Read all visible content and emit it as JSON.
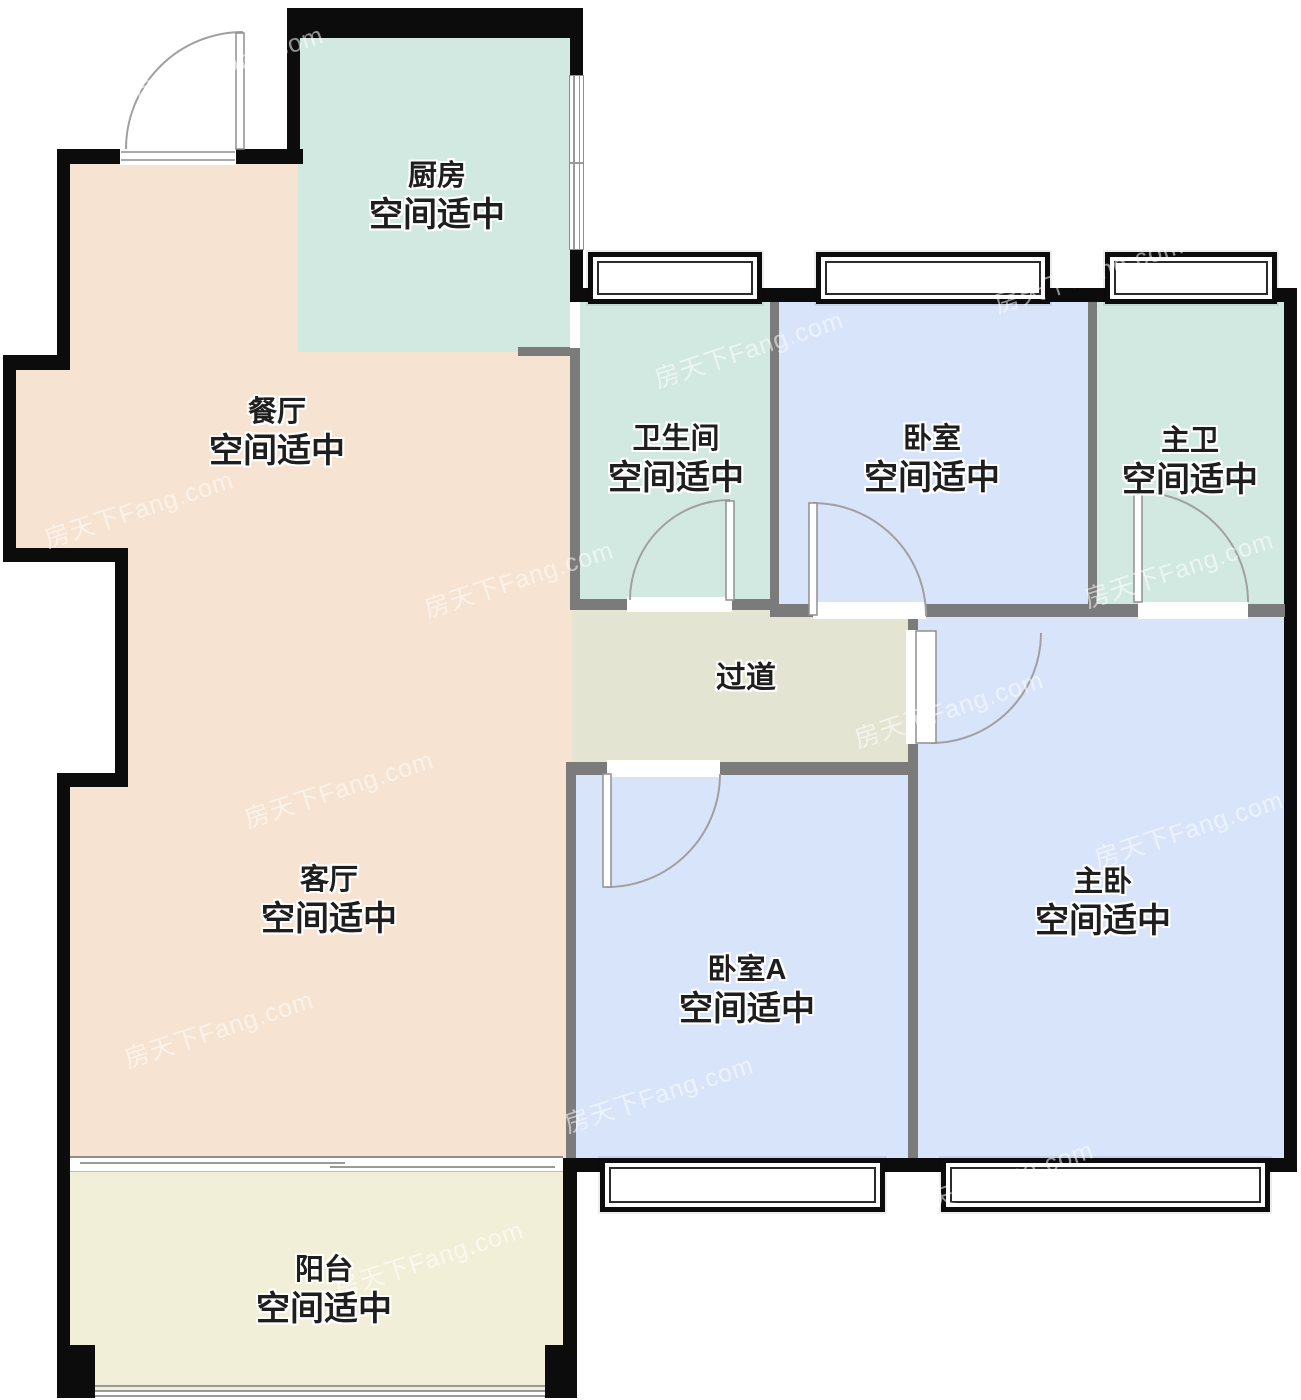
{
  "plan": {
    "watermark": "房天下Fang.com",
    "size_note_default": "空间适中",
    "rooms": [
      {
        "id": "kitchen",
        "name": "厨房",
        "note": "空间适中"
      },
      {
        "id": "dining",
        "name": "餐厅",
        "note": "空间适中"
      },
      {
        "id": "bathroom",
        "name": "卫生间",
        "note": "空间适中"
      },
      {
        "id": "bedroom",
        "name": "卧室",
        "note": "空间适中"
      },
      {
        "id": "master-bath",
        "name": "主卫",
        "note": "空间适中"
      },
      {
        "id": "hallway",
        "name": "过道",
        "note": ""
      },
      {
        "id": "living",
        "name": "客厅",
        "note": "空间适中"
      },
      {
        "id": "bedroom-a",
        "name": "卧室A",
        "note": "空间适中"
      },
      {
        "id": "master-bedroom",
        "name": "主卧",
        "note": "空间适中"
      },
      {
        "id": "balcony",
        "name": "阳台",
        "note": "空间适中"
      }
    ],
    "colors": {
      "exterior_wall": "#0c0c0c",
      "interior_wall": "#7b7b7b",
      "kitchen_bath": "#d2e9e1",
      "dining_living": "#f6e3d1",
      "bedrooms": "#d8e4fa",
      "hallway": "#e4e4d3",
      "balcony": "#f2efd8",
      "label_text": "#1e1e1e"
    }
  }
}
